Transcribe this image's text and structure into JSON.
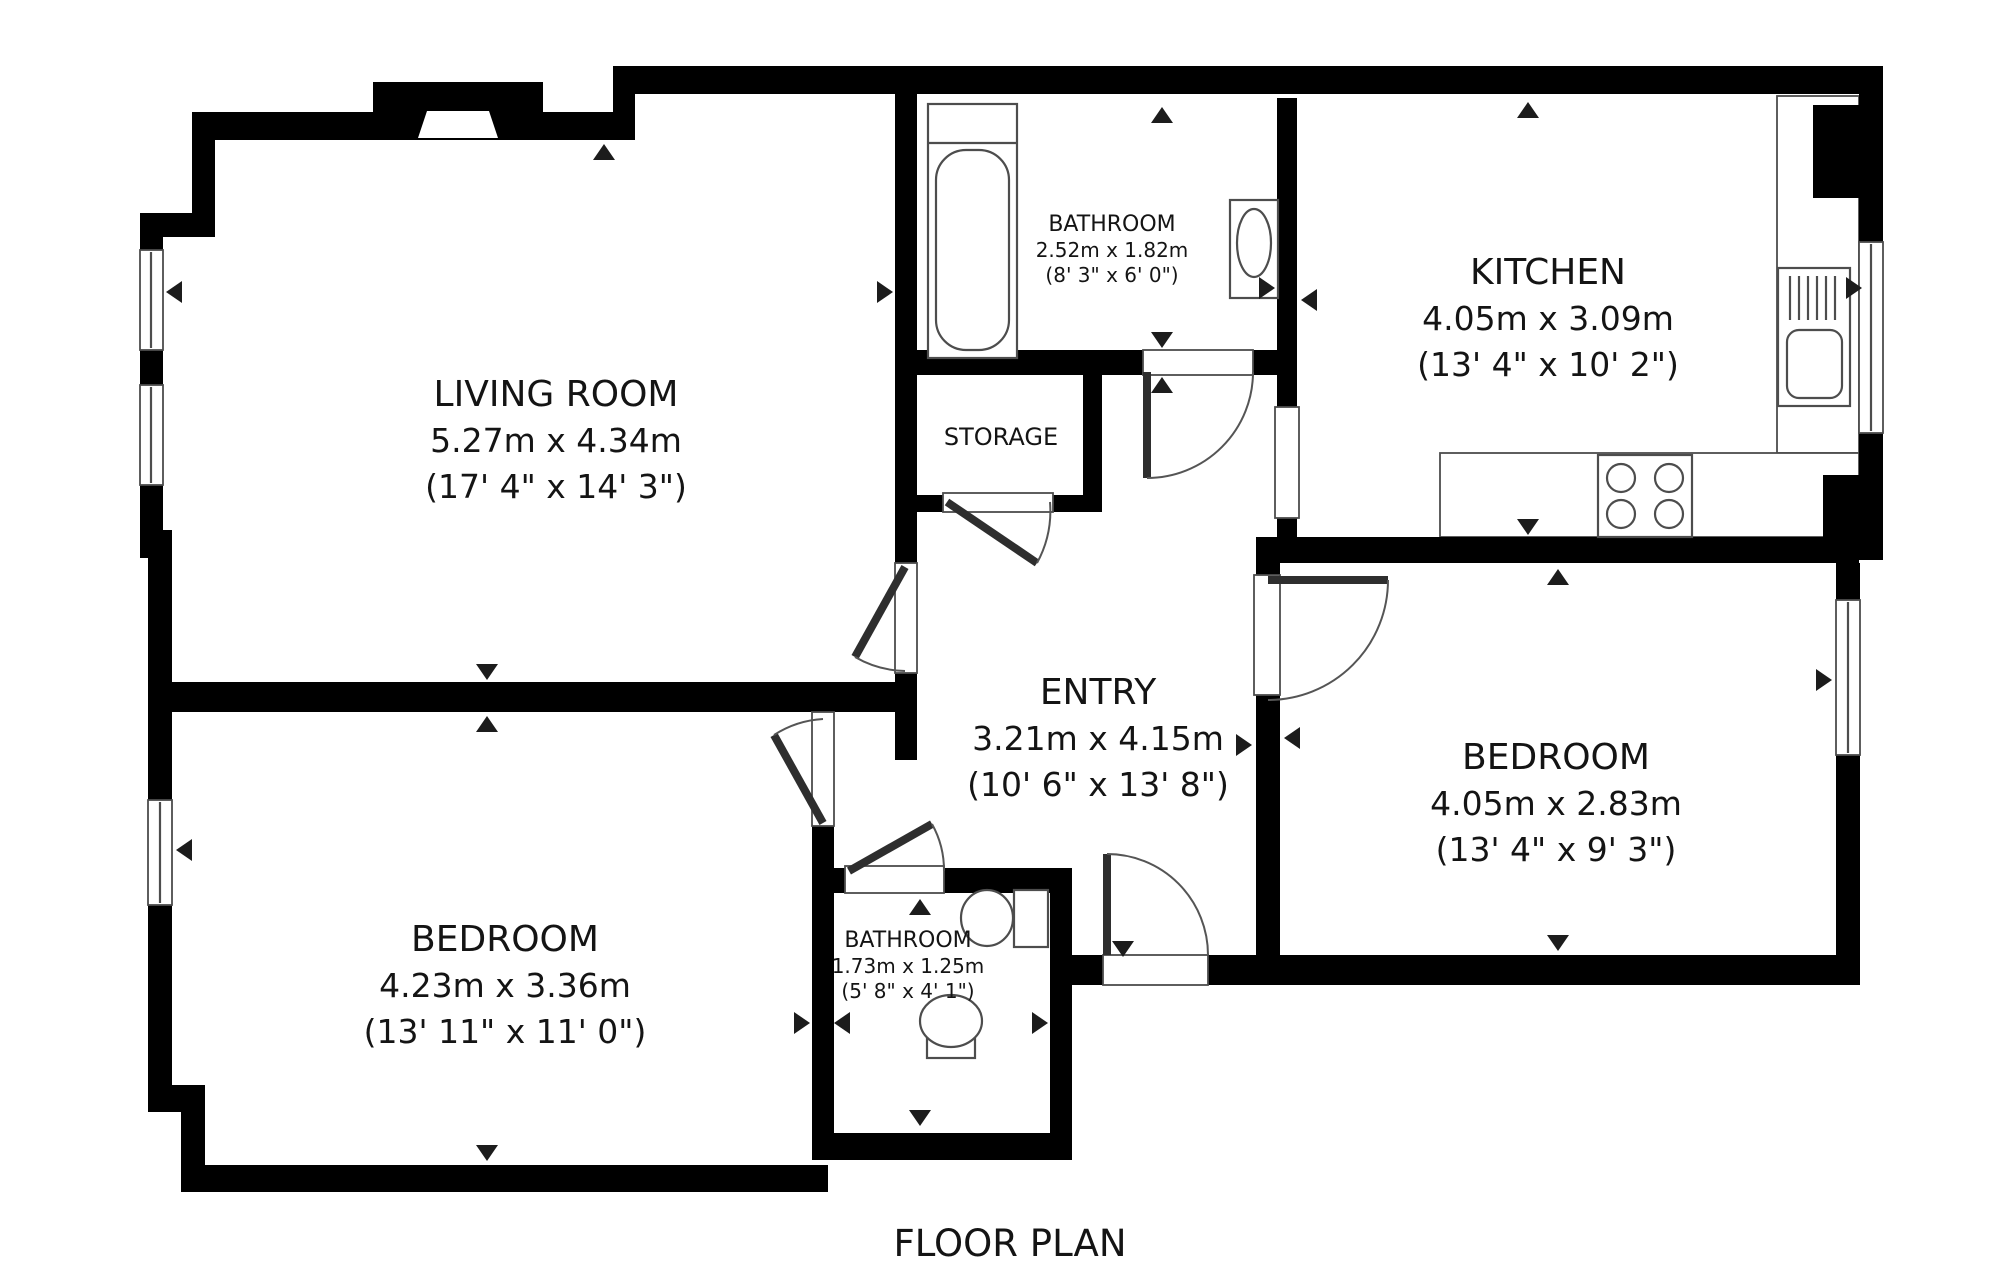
{
  "title": "FLOOR PLAN",
  "colors": {
    "wall": "#000000",
    "fixture_line": "#4d4d4d",
    "background": "#ffffff",
    "text": "#141414"
  },
  "rooms": {
    "living_room": {
      "name": "LIVING ROOM",
      "metric": "5.27m x 4.34m",
      "imperial": "(17' 4\" x 14' 3\")"
    },
    "bathroom_top": {
      "name": "BATHROOM",
      "metric": "2.52m x 1.82m",
      "imperial": "(8' 3\" x 6' 0\")"
    },
    "kitchen": {
      "name": "KITCHEN",
      "metric": "4.05m x 3.09m",
      "imperial": "(13' 4\" x 10' 2\")"
    },
    "storage": {
      "name": "STORAGE"
    },
    "entry": {
      "name": "ENTRY",
      "metric": "3.21m x 4.15m",
      "imperial": "(10' 6\" x 13' 8\")"
    },
    "bedroom_right": {
      "name": "BEDROOM",
      "metric": "4.05m x 2.83m",
      "imperial": "(13' 4\" x 9' 3\")"
    },
    "bedroom_left": {
      "name": "BEDROOM",
      "metric": "4.23m x 3.36m",
      "imperial": "(13' 11\" x 11' 0\")"
    },
    "bathroom_bottom": {
      "name": "BATHROOM",
      "metric": "1.73m x 1.25m",
      "imperial": "(5' 8\" x 4' 1\")"
    }
  }
}
